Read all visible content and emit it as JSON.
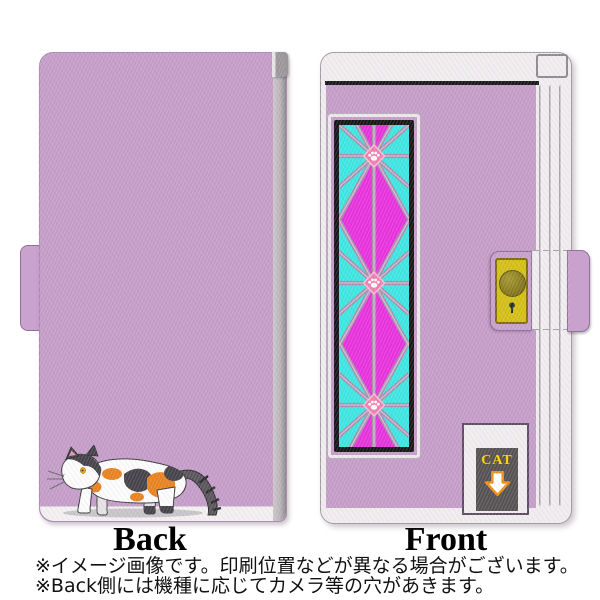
{
  "views": {
    "back": {
      "label": "Back"
    },
    "front": {
      "label": "Front",
      "sign_text": "CAT"
    }
  },
  "footnotes": {
    "line1": "※イメージ画像です。印刷位置などが異なる場合がございます。",
    "line2": "※Back側には機種に応じてカメラ等の穴があきます。"
  },
  "colors": {
    "case_lilac": "#c59dc9",
    "trim_white": "#f0edef",
    "glass_magenta": "#e832dd",
    "glass_cyan": "#3ee6e2",
    "lattice_mauve": "#a78fab",
    "paw_diamond_pink": "#ee7fae",
    "clasp_gold": "#d4bf16",
    "sign_gray": "#565254",
    "sign_text_yellow": "#ffd400",
    "arrow_orange": "#ee8f1a",
    "cat_orange": "#e8831f",
    "cat_dark_gray": "#45424a"
  },
  "icons": {
    "cat": "cat-illustration",
    "paw": "paw-icon",
    "down_arrow": "down-arrow-icon",
    "keyhole": "keyhole-icon",
    "clasp_button": "clasp-button-icon"
  }
}
